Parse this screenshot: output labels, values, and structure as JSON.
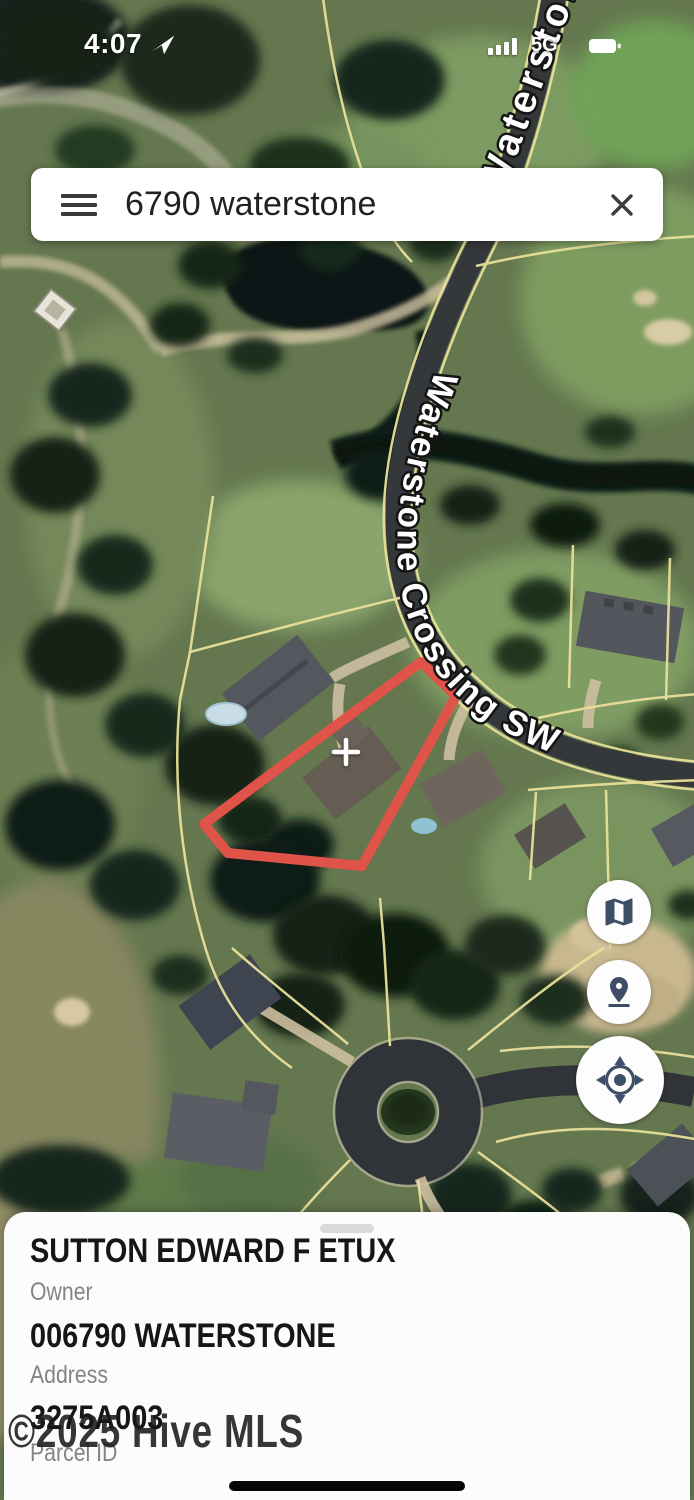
{
  "status_bar": {
    "time": "4:07",
    "network": "5G"
  },
  "search": {
    "query": "6790 waterstone"
  },
  "map": {
    "type": "satellite-parcel-viewer",
    "street_label_main": "Waterstone Crossing SW",
    "street_label_top": "Waterstone",
    "highlight_parcel_color": "#e05348",
    "parcel_line_color": "#e8e09a",
    "controls": [
      {
        "icon": "map-layers-icon"
      },
      {
        "icon": "pin-drop-icon"
      },
      {
        "icon": "compass-icon"
      }
    ]
  },
  "parcel_sheet": {
    "owner_value": "SUTTON EDWARD F ETUX",
    "owner_label": "Owner",
    "address_value": "006790 WATERSTONE",
    "address_label": "Address",
    "parcel_id_value": "3275A003",
    "parcel_id_label": "Parcel ID"
  },
  "watermark": "©2025 Hive MLS"
}
